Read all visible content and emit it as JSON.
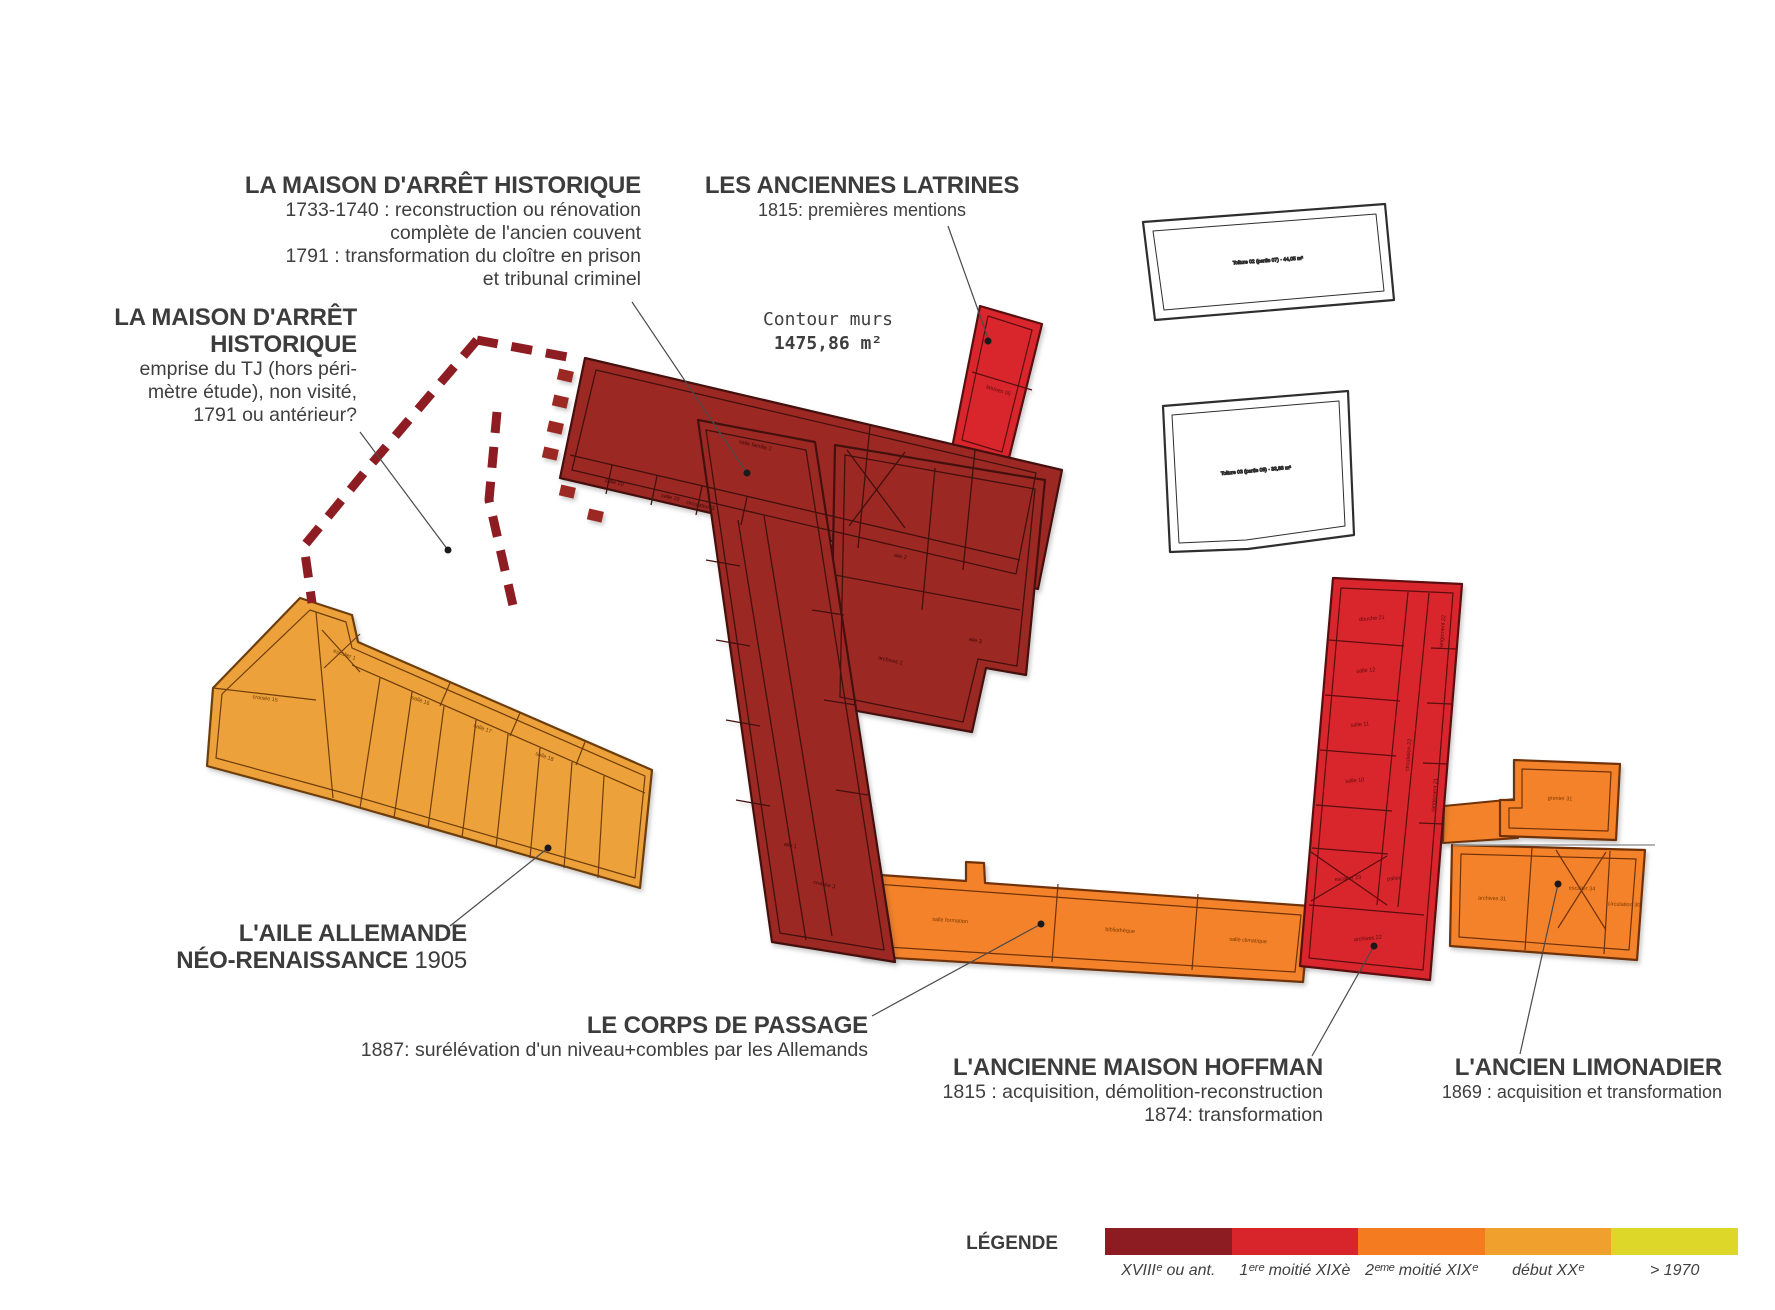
{
  "annotations": {
    "maison_arret": {
      "title": "LA MAISON D'ARRÊT HISTORIQUE",
      "lines": [
        "1733-1740 : reconstruction ou rénovation",
        "complète de l'ancien couvent",
        "1791 : transformation du cloître en prison",
        "et tribunal criminel"
      ]
    },
    "emprise": {
      "title_line1": "LA MAISON D'ARRÊT",
      "title_line2": "HISTORIQUE",
      "lines": [
        "emprise du TJ (hors péri-",
        "mètre étude), non visité,",
        "1791 ou antérieur?"
      ]
    },
    "latrines": {
      "title": "LES ANCIENNES LATRINES",
      "subtitle": "1815: premières mentions"
    },
    "contour": {
      "line1": "Contour murs",
      "line2": "1475,86 m²"
    },
    "aile_allemande": {
      "title_line1": "L'AILE ALLEMANDE",
      "title_line2": "NÉO-RENAISSANCE",
      "year": "1905"
    },
    "corps_passage": {
      "title": "LE CORPS DE PASSAGE",
      "subtitle": "1887: surélévation d'un niveau+combles par les Allemands"
    },
    "hoffman": {
      "title": "L'ANCIENNE MAISON HOFFMAN",
      "lines": [
        "1815 : acquisition, démolition-reconstruction",
        "1874: transformation"
      ]
    },
    "limonadier": {
      "title": "L'ANCIEN LIMONADIER",
      "subtitle": "1869 : acquisition et transformation"
    }
  },
  "legend": {
    "label": "LÉGENDE",
    "items": [
      {
        "label": "XVIIIᵉ ou ant.",
        "color": "#8c1b22"
      },
      {
        "label": "1ᵉʳᵉ moitié XIXè",
        "color": "#d8252b"
      },
      {
        "label": "2ᵉᵐᵉ moitié XIXᵉ",
        "color": "#f47b20"
      },
      {
        "label": "début XXᵉ",
        "color": "#f0a02c"
      },
      {
        "label": "> 1970",
        "color": "#dcd728"
      }
    ]
  },
  "plan": {
    "colors": {
      "xviii_dark_red": "#9c2823",
      "xix_first_red": "#d8262c",
      "xix_second_orange": "#f4822a",
      "xx_gold": "#eda13b",
      "wall_dark": "#43100e",
      "white_building_stroke": "#2e2e2e",
      "dashed_outline": "#8d1d23",
      "leader_line": "#4a4a4a"
    },
    "room_labels": [
      "salle famille 2",
      "circulation 3",
      "salle 20",
      "salle 26",
      "aile 2",
      "aile 3",
      "archives 2",
      "aile 1",
      "croisée 3",
      "latrines 05",
      "Toiture 02 (partie 07) · 44,05 m²",
      "Toiture 03 (partie 08) · 33,88 m²",
      "croisée 15",
      "escalier 1",
      "salle 16",
      "salle 17",
      "salle 18",
      "salle formation",
      "bibliothèque",
      "salle climatique",
      "douche 21",
      "salle 12",
      "salle 11",
      "salle 10",
      "circulation 22",
      "rangement 22",
      "rangement 21",
      "escalier 23",
      "palier",
      "archives 22",
      "grenier 31",
      "archives 31",
      "escalier 34",
      "circulation 30"
    ]
  }
}
